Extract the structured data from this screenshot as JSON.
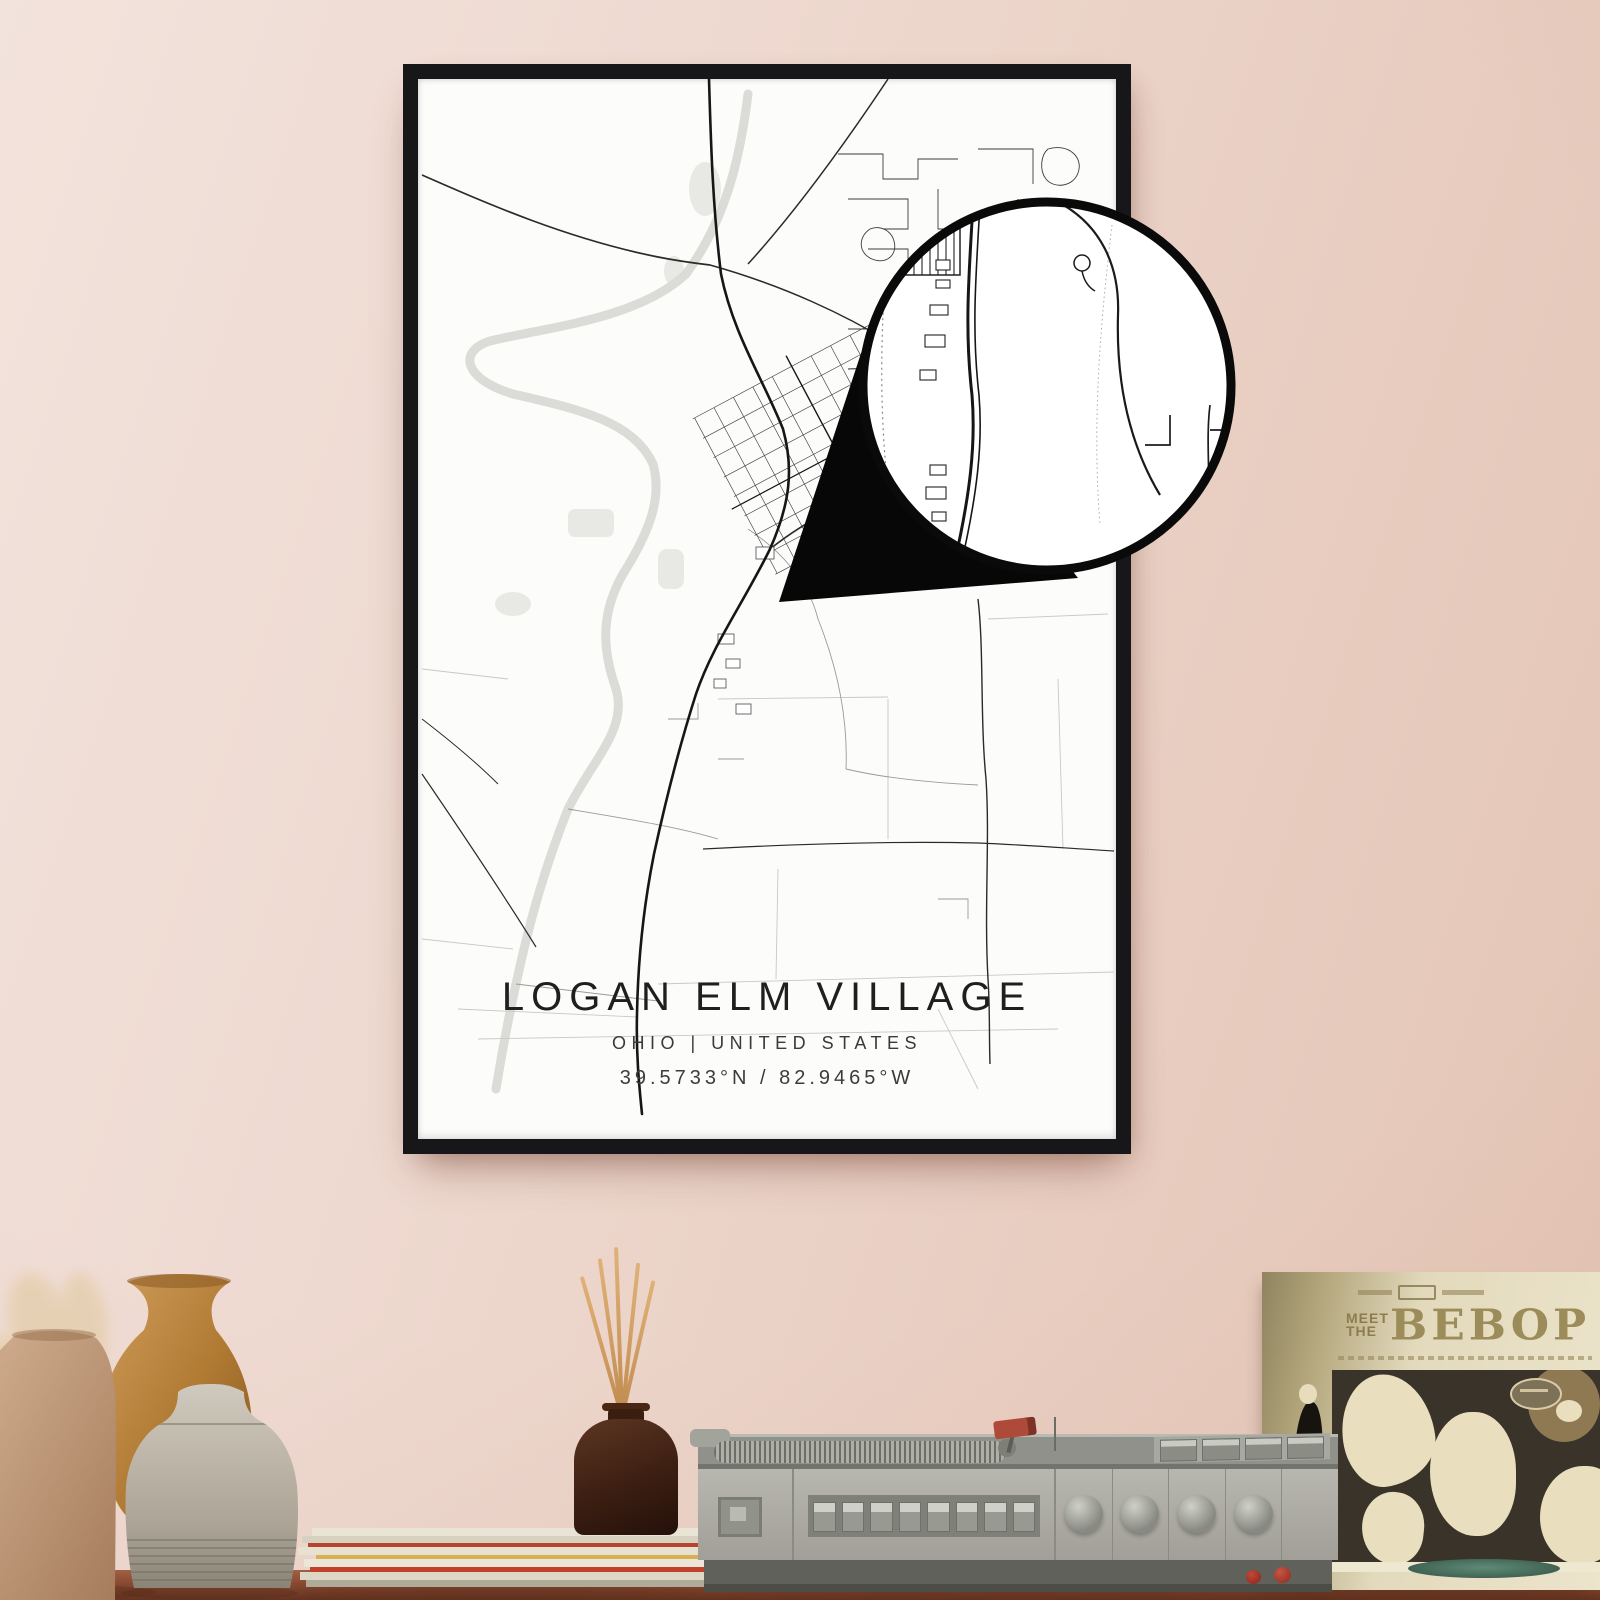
{
  "scene": {
    "description": "Framed minimalist street-map poster hanging on a pink wall above a shelf styled with vases, dried pampas grass, magazines, a reed diffuser, a vintage record player and a record sleeve",
    "wall_color": "#eed9d0",
    "frame_color": "#17171a",
    "poster_background": "#fcfcfb",
    "table_color": "#8a4c33"
  },
  "poster": {
    "title": "LOGAN ELM VILLAGE",
    "region_line": "OHIO | UNITED STATES",
    "coordinates": "39.5733°N / 82.9465°W",
    "map_road_color": "#1a1a1a",
    "map_minor_road_color": "#3c3c3c",
    "map_water_color": "#dbdbd7",
    "map_park_color": "#e8e8e5"
  },
  "magnifier": {
    "style": "circular zoom inset with black rim and black pointer wedge",
    "rim_color": "#0a0a0a"
  },
  "record_sleeve": {
    "meet": "MEET",
    "the": "THE",
    "bebop": "BEBOP",
    "background_color": "#e3dabd",
    "title_color": "#9c8c59",
    "panel_color": "#39332a"
  },
  "shelf": {
    "items": [
      {
        "name": "dried-pampas-stems"
      },
      {
        "name": "tan-ceramic-vase"
      },
      {
        "name": "amber-ceramic-vase"
      },
      {
        "name": "gray-ridged-vase"
      },
      {
        "name": "magazine-stack"
      },
      {
        "name": "reed-diffuser"
      },
      {
        "name": "vintage-record-player"
      },
      {
        "name": "record-sleeve"
      },
      {
        "name": "green-vinyl-record"
      },
      {
        "name": "red-berries"
      }
    ]
  }
}
